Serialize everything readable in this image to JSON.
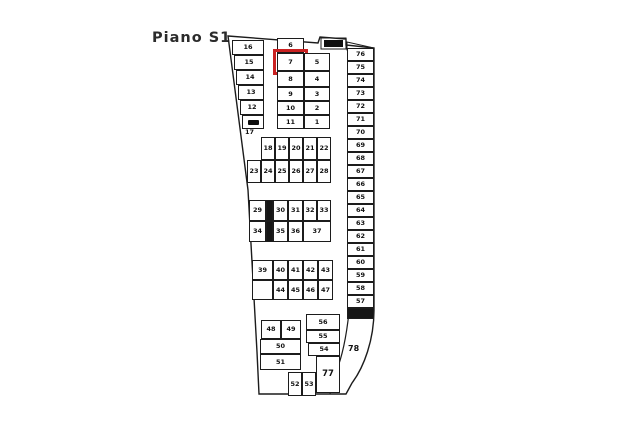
{
  "page": {
    "title": "Piano S1",
    "background": "#ffffff",
    "ink": "#1c1c1c",
    "highlight_color": "#c92121",
    "highlighted_space": "7"
  },
  "plan": {
    "groups": [
      {
        "name": "left-column",
        "cells": [
          {
            "t": "16",
            "r": [
              232,
              40,
              32,
              15
            ]
          },
          {
            "t": "15",
            "r": [
              234,
              55,
              30,
              15
            ]
          },
          {
            "t": "14",
            "r": [
              236,
              70,
              28,
              15
            ]
          },
          {
            "t": "13",
            "r": [
              238,
              85,
              26,
              15
            ]
          },
          {
            "t": "12",
            "r": [
              240,
              100,
              24,
              15
            ]
          },
          {
            "t": "",
            "r": [
              242,
              115,
              22,
              14
            ],
            "mark": true
          }
        ]
      },
      {
        "name": "center-block-left",
        "cells": [
          {
            "t": "6",
            "r": [
              277,
              38,
              27,
              15
            ]
          },
          {
            "t": "7",
            "r": [
              277,
              53,
              27,
              18
            ],
            "highlight": true
          },
          {
            "t": "8",
            "r": [
              277,
              71,
              27,
              16
            ]
          },
          {
            "t": "9",
            "r": [
              277,
              87,
              27,
              14
            ]
          },
          {
            "t": "10",
            "r": [
              277,
              101,
              27,
              14
            ]
          },
          {
            "t": "11",
            "r": [
              277,
              115,
              27,
              14
            ]
          }
        ]
      },
      {
        "name": "center-block-right",
        "cells": [
          {
            "t": "5",
            "r": [
              304,
              53,
              26,
              18
            ]
          },
          {
            "t": "4",
            "r": [
              304,
              71,
              26,
              16
            ]
          },
          {
            "t": "3",
            "r": [
              304,
              87,
              26,
              14
            ]
          },
          {
            "t": "2",
            "r": [
              304,
              101,
              26,
              14
            ]
          },
          {
            "t": "1",
            "r": [
              304,
              115,
              26,
              14
            ]
          }
        ]
      },
      {
        "name": "upper-row-block-top",
        "cells": [
          {
            "t": "18",
            "r": [
              261,
              137,
              14,
              23
            ]
          },
          {
            "t": "19",
            "r": [
              275,
              137,
              14,
              23
            ]
          },
          {
            "t": "20",
            "r": [
              289,
              137,
              14,
              23
            ]
          },
          {
            "t": "21",
            "r": [
              303,
              137,
              14,
              23
            ]
          },
          {
            "t": "22",
            "r": [
              317,
              137,
              14,
              23
            ]
          }
        ]
      },
      {
        "name": "upper-row-block-bottom",
        "cells": [
          {
            "t": "23",
            "r": [
              247,
              160,
              14,
              23
            ]
          },
          {
            "t": "24",
            "r": [
              261,
              160,
              14,
              23
            ]
          },
          {
            "t": "25",
            "r": [
              275,
              160,
              14,
              23
            ]
          },
          {
            "t": "26",
            "r": [
              289,
              160,
              14,
              23
            ]
          },
          {
            "t": "27",
            "r": [
              303,
              160,
              14,
              23
            ]
          },
          {
            "t": "28",
            "r": [
              317,
              160,
              14,
              23
            ]
          }
        ]
      },
      {
        "name": "middle-row-block-top",
        "cells": [
          {
            "t": "29",
            "r": [
              249,
              200,
              17,
              21
            ]
          },
          {
            "t": "",
            "r": [
              266,
              200,
              7,
              21
            ],
            "dark": true
          },
          {
            "t": "30",
            "r": [
              273,
              200,
              15,
              21
            ]
          },
          {
            "t": "31",
            "r": [
              288,
              200,
              15,
              21
            ]
          },
          {
            "t": "32",
            "r": [
              303,
              200,
              14,
              21
            ]
          },
          {
            "t": "33",
            "r": [
              317,
              200,
              14,
              21
            ]
          }
        ]
      },
      {
        "name": "middle-row-block-bottom",
        "cells": [
          {
            "t": "34",
            "r": [
              249,
              221,
              17,
              21
            ]
          },
          {
            "t": "",
            "r": [
              266,
              221,
              7,
              21
            ],
            "dark": true
          },
          {
            "t": "35",
            "r": [
              273,
              221,
              15,
              21
            ]
          },
          {
            "t": "36",
            "r": [
              288,
              221,
              15,
              21
            ]
          },
          {
            "t": "37",
            "r": [
              303,
              221,
              28,
              21
            ]
          }
        ]
      },
      {
        "name": "lower-row-block-top",
        "cells": [
          {
            "t": "39",
            "r": [
              252,
              260,
              21,
              20
            ]
          },
          {
            "t": "40",
            "r": [
              273,
              260,
              15,
              20
            ]
          },
          {
            "t": "41",
            "r": [
              288,
              260,
              15,
              20
            ]
          },
          {
            "t": "42",
            "r": [
              303,
              260,
              15,
              20
            ]
          },
          {
            "t": "43",
            "r": [
              318,
              260,
              15,
              20
            ]
          }
        ]
      },
      {
        "name": "lower-row-block-bottom",
        "cells": [
          {
            "t": "",
            "r": [
              252,
              280,
              21,
              20
            ]
          },
          {
            "t": "44",
            "r": [
              273,
              280,
              15,
              20
            ]
          },
          {
            "t": "45",
            "r": [
              288,
              280,
              15,
              20
            ]
          },
          {
            "t": "46",
            "r": [
              303,
              280,
              15,
              20
            ]
          },
          {
            "t": "47",
            "r": [
              318,
              280,
              15,
              20
            ]
          }
        ]
      },
      {
        "name": "right-column",
        "cells": [
          {
            "t": "76",
            "r": [
              347,
              48,
              27,
              13
            ]
          },
          {
            "t": "75",
            "r": [
              347,
              61,
              27,
              13
            ]
          },
          {
            "t": "74",
            "r": [
              347,
              74,
              27,
              13
            ]
          },
          {
            "t": "73",
            "r": [
              347,
              87,
              27,
              13
            ]
          },
          {
            "t": "72",
            "r": [
              347,
              100,
              27,
              13
            ]
          },
          {
            "t": "71",
            "r": [
              347,
              113,
              27,
              13
            ]
          },
          {
            "t": "70",
            "r": [
              347,
              126,
              27,
              13
            ]
          },
          {
            "t": "69",
            "r": [
              347,
              139,
              27,
              13
            ]
          },
          {
            "t": "68",
            "r": [
              347,
              152,
              27,
              13
            ]
          },
          {
            "t": "67",
            "r": [
              347,
              165,
              27,
              13
            ]
          },
          {
            "t": "66",
            "r": [
              347,
              178,
              27,
              13
            ]
          },
          {
            "t": "65",
            "r": [
              347,
              191,
              27,
              13
            ]
          },
          {
            "t": "64",
            "r": [
              347,
              204,
              27,
              13
            ]
          },
          {
            "t": "63",
            "r": [
              347,
              217,
              27,
              13
            ]
          },
          {
            "t": "62",
            "r": [
              347,
              230,
              27,
              13
            ]
          },
          {
            "t": "61",
            "r": [
              347,
              243,
              27,
              13
            ]
          },
          {
            "t": "60",
            "r": [
              347,
              256,
              27,
              13
            ]
          },
          {
            "t": "59",
            "r": [
              347,
              269,
              27,
              13
            ]
          },
          {
            "t": "58",
            "r": [
              347,
              282,
              27,
              13
            ]
          },
          {
            "t": "57",
            "r": [
              347,
              295,
              27,
              13
            ]
          },
          {
            "t": "",
            "r": [
              347,
              308,
              27,
              11
            ],
            "dark": true
          }
        ]
      },
      {
        "name": "bottom-left-stack",
        "cells": [
          {
            "t": "48",
            "r": [
              261,
              320,
              20,
              19
            ]
          },
          {
            "t": "49",
            "r": [
              281,
              320,
              20,
              19
            ]
          },
          {
            "t": "50",
            "r": [
              260,
              339,
              41,
              15
            ]
          },
          {
            "t": "51",
            "r": [
              260,
              354,
              41,
              16
            ]
          },
          {
            "t": "52",
            "r": [
              288,
              372,
              14,
              24
            ]
          },
          {
            "t": "53",
            "r": [
              302,
              372,
              14,
              24
            ]
          }
        ]
      },
      {
        "name": "bottom-middle-stack",
        "cells": [
          {
            "t": "56",
            "r": [
              306,
              314,
              34,
              16
            ]
          },
          {
            "t": "55",
            "r": [
              306,
              330,
              34,
              13
            ]
          },
          {
            "t": "54",
            "r": [
              308,
              343,
              32,
              13
            ]
          },
          {
            "t": "77",
            "r": [
              316,
              356,
              24,
              37
            ],
            "big": true
          }
        ]
      }
    ],
    "free_labels": [
      {
        "t": "17",
        "x": 245,
        "y": 128
      },
      {
        "t": "78",
        "x": 348,
        "y": 344,
        "big": true
      }
    ]
  }
}
